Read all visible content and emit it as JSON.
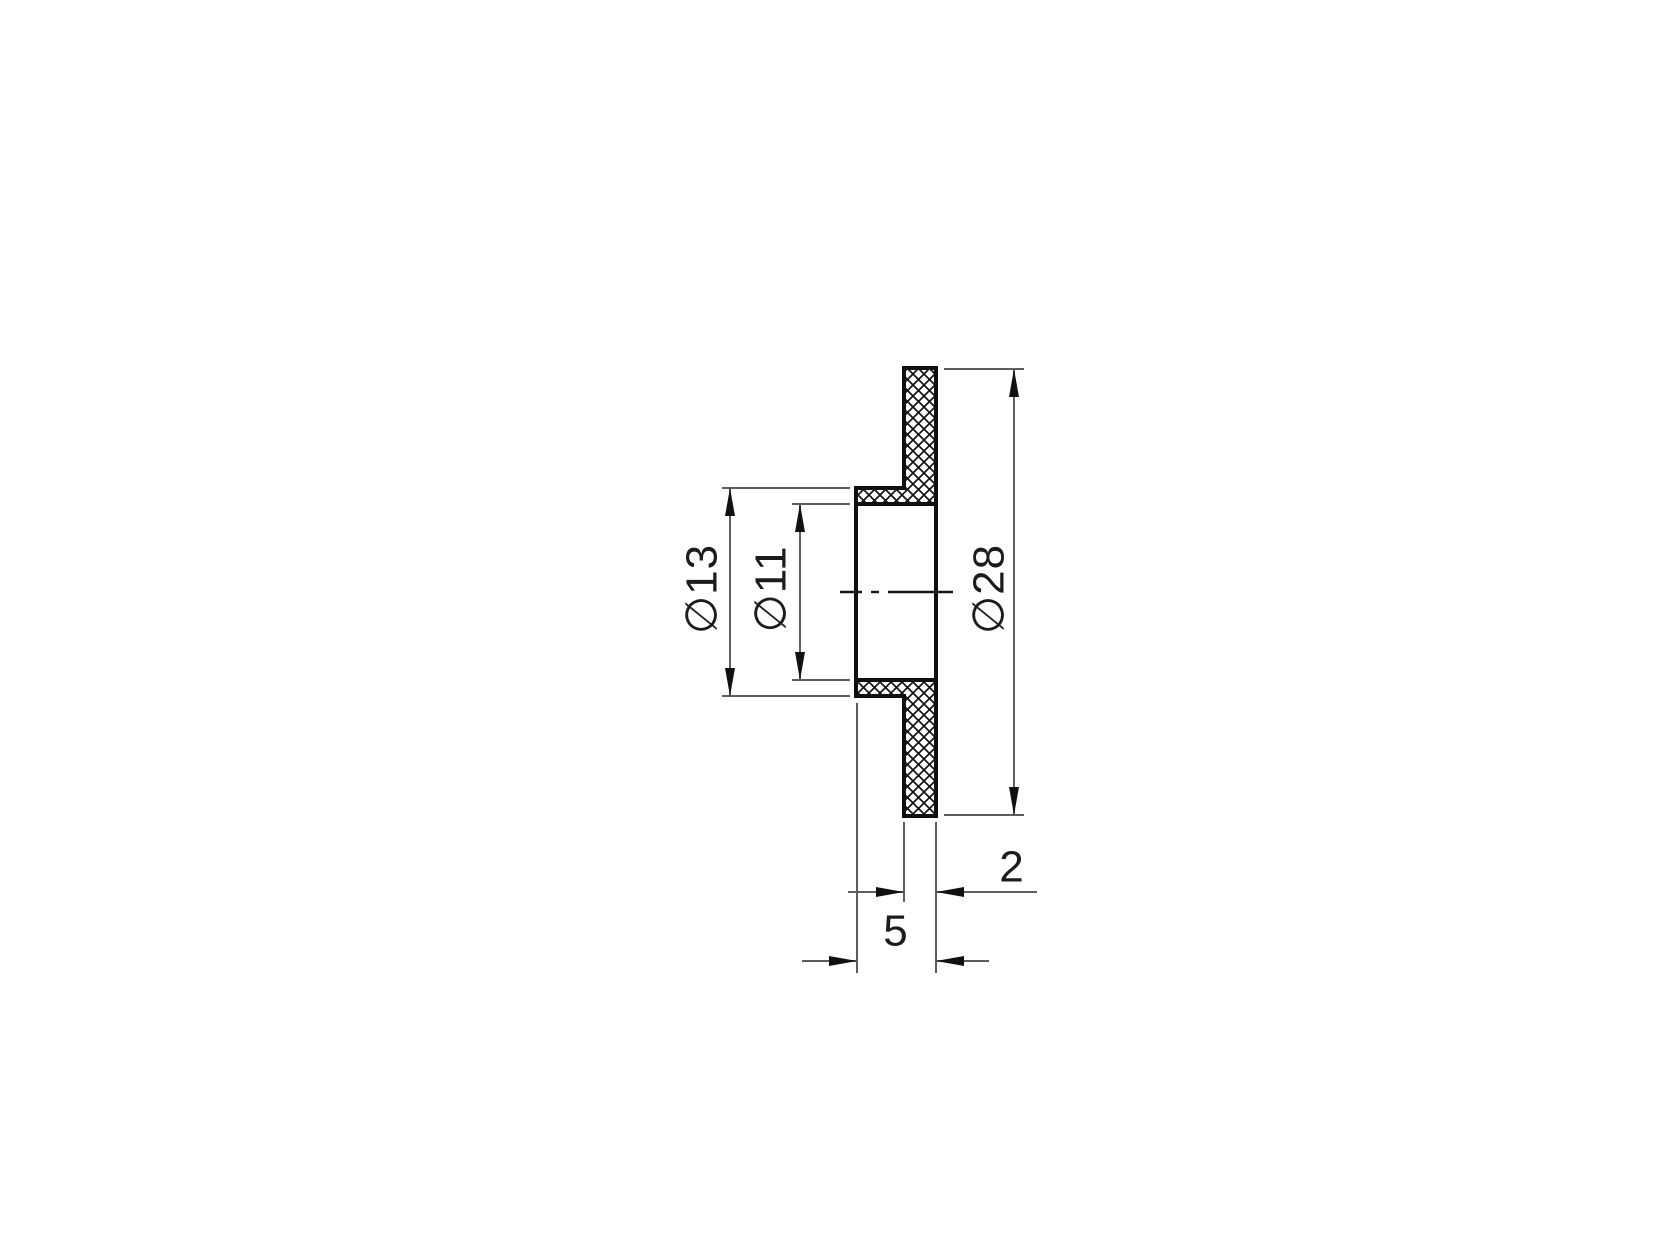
{
  "drawing": {
    "kind": "2D section view of a flanged bushing",
    "labels": {
      "flange_diameter": "∅28",
      "hub_diameter": "∅13",
      "bore_diameter": "∅11",
      "flange_thickness": "2",
      "overall_length": "5"
    },
    "values": {
      "flange_diameter_mm": 28,
      "hub_diameter_mm": 13,
      "bore_diameter_mm": 11,
      "flange_thickness_mm": 2,
      "overall_length_mm": 5
    },
    "colors": {
      "background": "#ffffff",
      "part_outline": "#111111",
      "dimension_lines": "#5d5d5d",
      "text": "#1c1c1c"
    }
  }
}
